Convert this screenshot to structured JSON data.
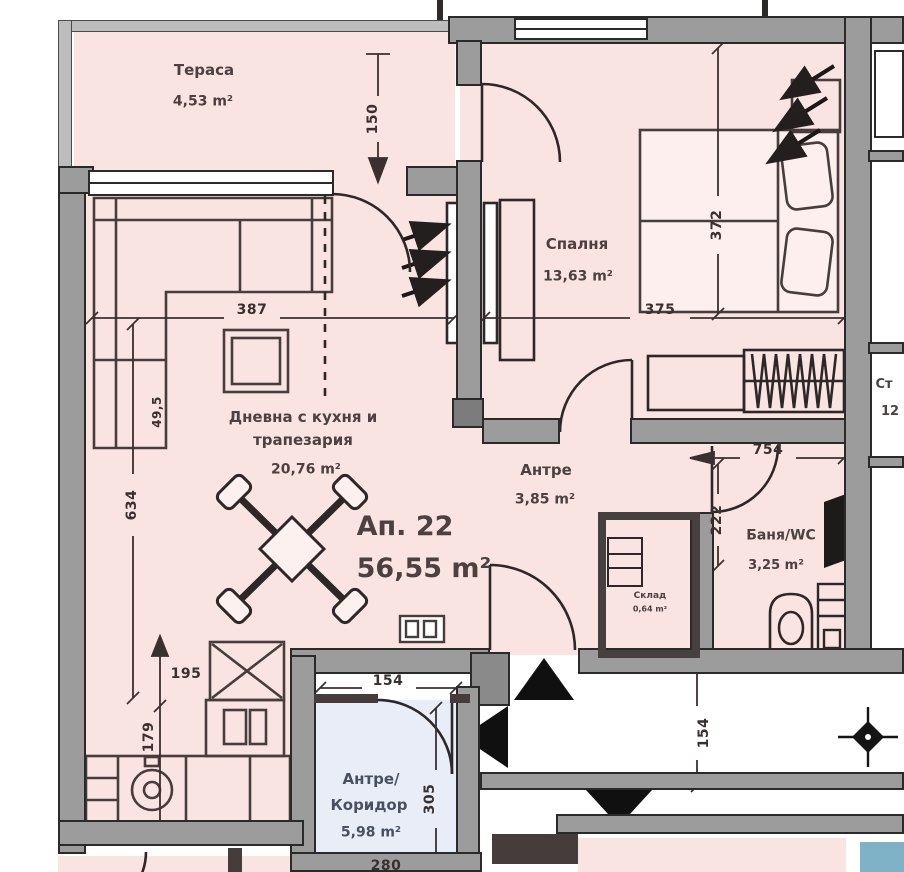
{
  "labels": {
    "apartment_no": "Ап. 22",
    "apartment_area": "56,55 m²",
    "terrace_name": "Тераса",
    "terrace_area": "4,53 m²",
    "bedroom_name": "Спалня",
    "bedroom_area": "13,63 m²",
    "living_name1": "Дневна с кухня и",
    "living_name2": "трапезария",
    "living_area": "20,76 m²",
    "antre_name": "Антре",
    "antre_area": "3,85 m²",
    "bath_name": "Баня/WC",
    "bath_area": "3,25 m²",
    "storage_name": "Склад",
    "storage_area": "0,64 m²",
    "corridor_name1": "Антре/",
    "corridor_name2": "Коридор",
    "corridor_area": "5,98 m²",
    "neighbor_name": "Ст",
    "neighbor_area": "12"
  },
  "dims": {
    "d150": "150",
    "d387": "387",
    "d375": "375",
    "d372": "372",
    "d634": "634",
    "d49": "49,5",
    "d195": "195",
    "d179": "179",
    "d754": "754",
    "d222": "222",
    "d154a": "154",
    "d305": "305",
    "d154b": "154",
    "d280": "280"
  },
  "colors": {
    "room_fill": "#f9e4e2",
    "corridor_fill": "#e9edf7",
    "wall_gray": "#9c9c9c",
    "line_dark": "#453c3b",
    "teal_patch": "#7fb2c7"
  }
}
